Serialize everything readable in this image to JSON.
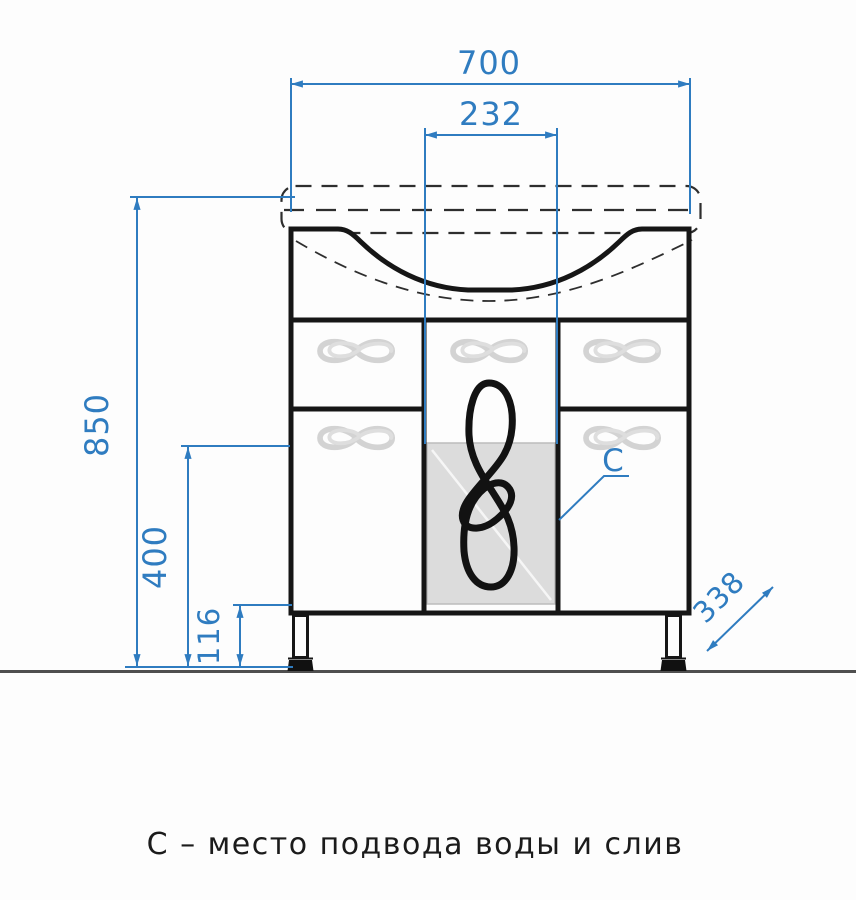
{
  "drawing": {
    "caption": "С – место подвода воды и слив",
    "dimensions": {
      "overall_width": "700",
      "drain_opening_width": "232",
      "overall_height": "850",
      "lower_section_height": "400",
      "leg_height": "116",
      "depth": "338"
    },
    "labels": {
      "connection_marker": "C"
    },
    "colors": {
      "dimension_blue": "#2f7cc0",
      "outline_black": "#161616",
      "ornament_gray": "#d3d3d3",
      "panel_gray": "#dcdcdc",
      "floor_gray": "#4f4f4f"
    }
  }
}
